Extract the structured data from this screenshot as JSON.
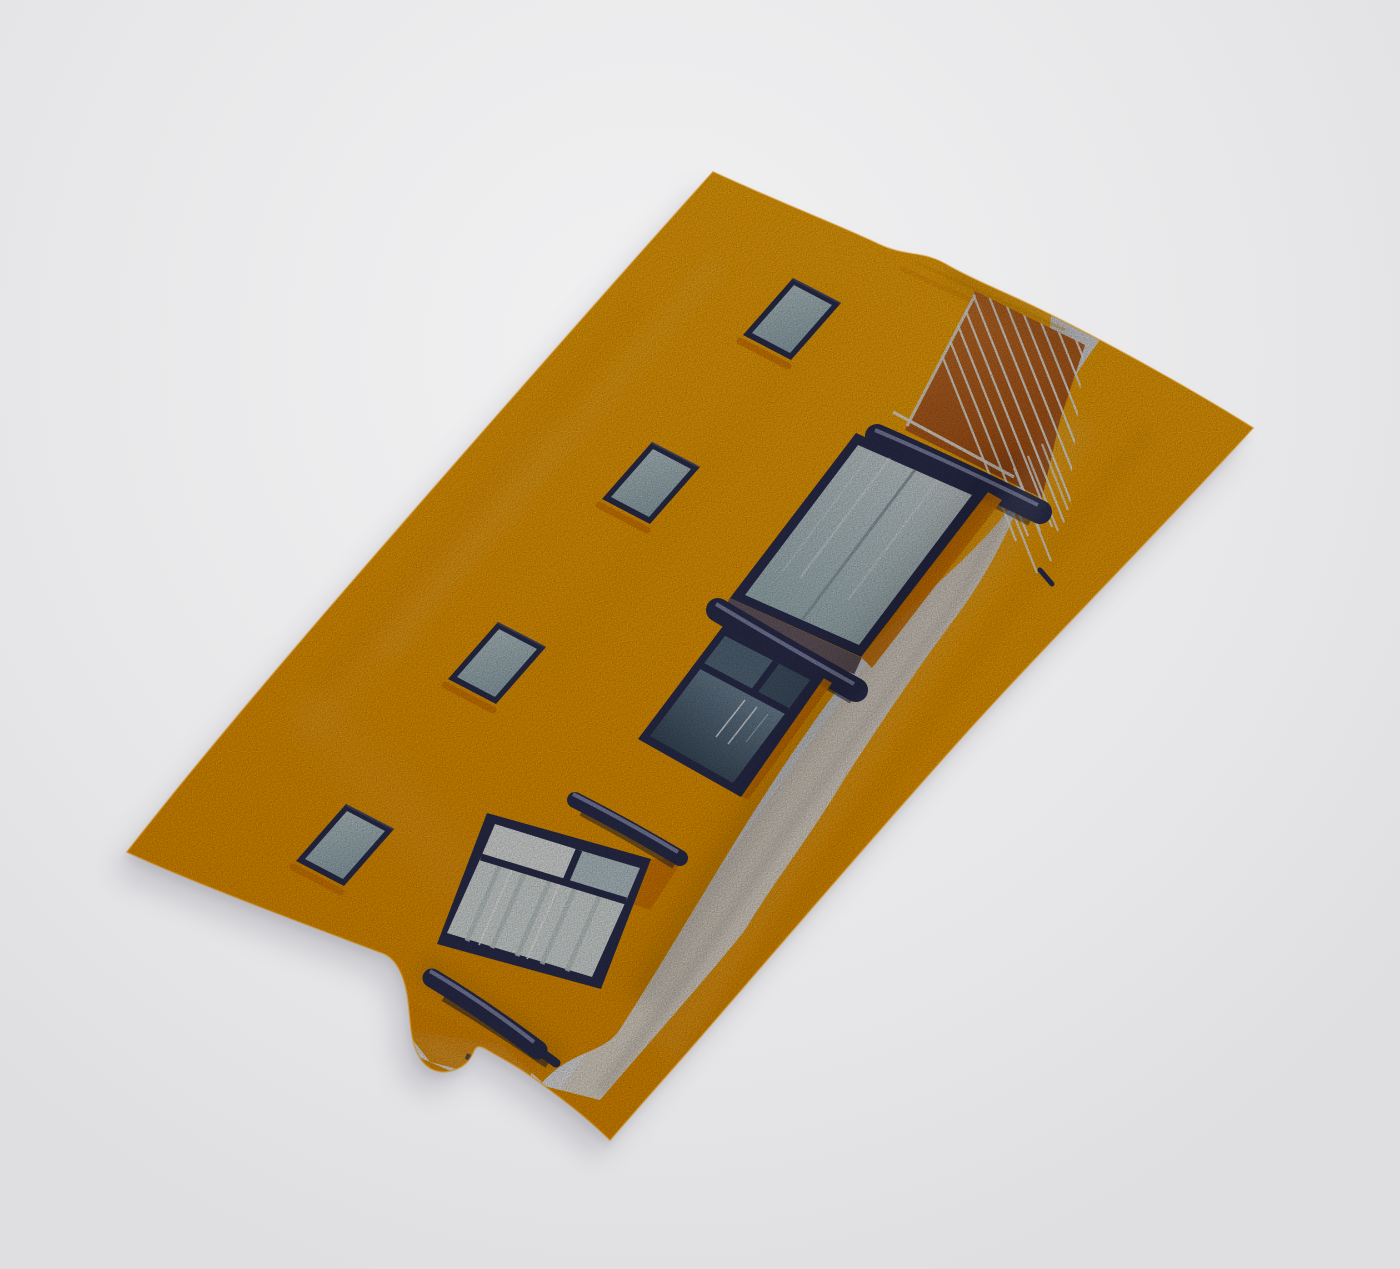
{
  "scene": {
    "subject": "towel-mockup",
    "print_motif": "orange-building-facade",
    "small_window_count": 4,
    "railing_bar_count": 11
  },
  "colors": {
    "background_light": "#f1f1f2",
    "background": "#e7e7e9",
    "background_edge": "#dfdfe2",
    "shadow_soft": "#7d7d88",
    "towel_yellow_light": "#ffae0a",
    "towel_yellow": "#fba303",
    "towel_yellow_deep": "#f09500",
    "towel_edge": "#c87f00",
    "fold_orange": "#f09200",
    "orange_shadow": "#e07c02",
    "stripe_white_top": "#e4e3e6",
    "stripe_white_bottom": "#f2f1f3",
    "stripe_shade": "#c9c8cc",
    "rust_light": "#d0752a",
    "rust_dark": "#a64d11",
    "railing_white": "#f3f0e8",
    "navy": "#2d3152",
    "navy_deep": "#1b1e36",
    "navy_soft": "#565b7e",
    "navy_highlight": "#8489ae",
    "sill_taupe": "#6e5f66",
    "pale_glass_light": "#d3dee0",
    "pale_glass": "#adc2c7",
    "glass_divider": "#97a9ae",
    "small_glass_light": "#c6d6d9",
    "small_glass": "#9db4bc",
    "dark_glass_light": "#7e95a9",
    "dark_glass": "#2f4052",
    "dark_pane_left": "#5b7084",
    "dark_pane_right": "#46586c",
    "curtain": "#e6ebea",
    "curtain_streak": "#ccd7d6",
    "transom_white": "#eff2f1",
    "transom_blue": "#c2d3d8",
    "white_reflection": "#ffffff",
    "shade_dark": "#000000"
  }
}
